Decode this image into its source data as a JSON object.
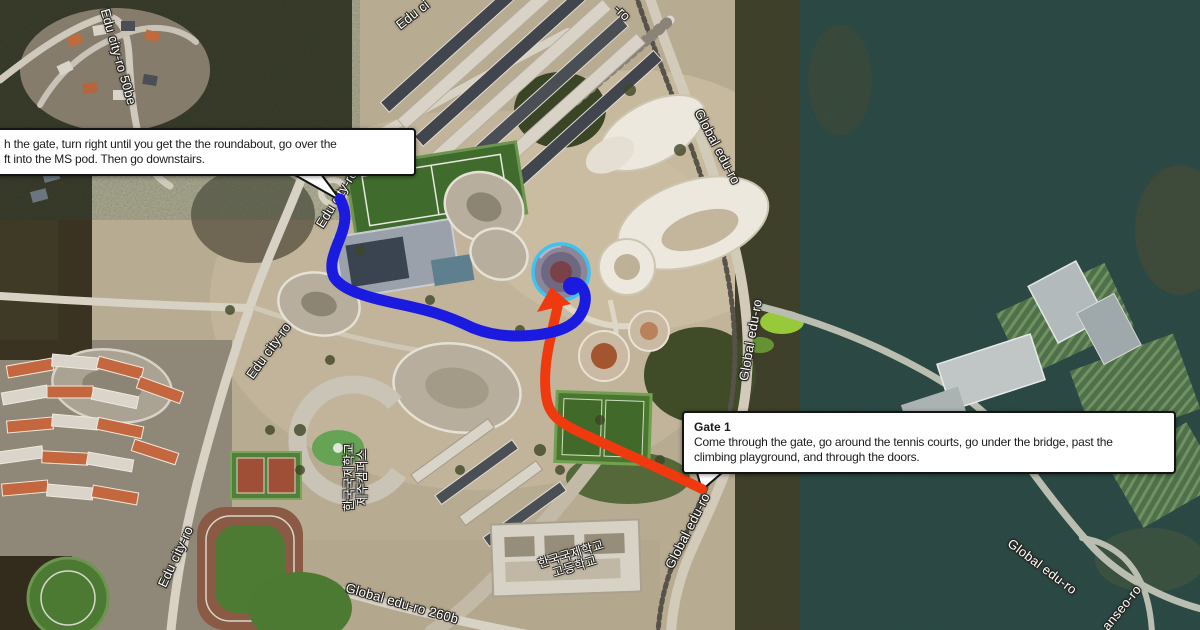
{
  "map": {
    "road_labels": [
      {
        "text": "Edu city-ro 50be",
        "x": 118,
        "y": 57,
        "rot": 74,
        "size": 13
      },
      {
        "text": "Edu ci",
        "x": 413,
        "y": 15,
        "rot": -38,
        "size": 13
      },
      {
        "text": "-ro",
        "x": 622,
        "y": 13,
        "rot": 45,
        "size": 13
      },
      {
        "text": "Global edu-ro",
        "x": 717,
        "y": 147,
        "rot": 62,
        "size": 13
      },
      {
        "text": "Global edu-ro",
        "x": 751,
        "y": 340,
        "rot": -80,
        "size": 13
      },
      {
        "text": "Global edu-ro",
        "x": 688,
        "y": 531,
        "rot": -63,
        "size": 13
      },
      {
        "text": "Edu city-ro",
        "x": 337,
        "y": 199,
        "rot": -58,
        "size": 13
      },
      {
        "text": "Edu city-ro",
        "x": 269,
        "y": 351,
        "rot": -54,
        "size": 13
      },
      {
        "text": "Edu city-ro",
        "x": 176,
        "y": 557,
        "rot": -65,
        "size": 13
      },
      {
        "text": "Global edu-ro 260b",
        "x": 402,
        "y": 604,
        "rot": 16,
        "size": 13
      },
      {
        "text": "Global edu-ro",
        "x": 1042,
        "y": 567,
        "rot": 37,
        "size": 13
      },
      {
        "text": "anseo-ro",
        "x": 1122,
        "y": 608,
        "rot": -51,
        "size": 13
      },
      {
        "text": "한국국제학교\n제주캠퍼스",
        "x": 356,
        "y": 477,
        "rot": -90,
        "size": 12
      },
      {
        "text": "한국국제학교\n고등학교",
        "x": 573,
        "y": 561,
        "rot": -17,
        "size": 12
      }
    ],
    "routes": {
      "blue": {
        "color": "#1b1be0",
        "width": 11,
        "path": "M340,199 C346,211 347,221 340,238 C333,255 329,266 334,277 C341,289 362,296 394,303 C428,310 446,315 473,328 C498,338 523,337 543,334 C561,331 572,326 579,317 C586,307 587,296 583,289 C579,282 573,281 571,285",
        "end": {
          "x": 572,
          "y": 286,
          "r": 9
        }
      },
      "red": {
        "color": "#ee3a0e",
        "width": 10,
        "path": "M702,489 C668,472 622,452 592,438 C566,426 551,419 547,401 C543,381 546,357 551,336 C554,321 557,311 558,304",
        "arrow_points": "551,287 537,312 571,304"
      }
    },
    "target_circle": {
      "color": "#3cc3f2",
      "x": 561,
      "y": 272,
      "r": 28,
      "stroke_width": 3.5
    }
  },
  "callouts": {
    "gate2": {
      "line1": "h the gate, turn right until you get the the roundabout, go over the",
      "line2": "ft into the MS pod. Then go downstairs."
    },
    "gate1": {
      "title": "Gate 1",
      "body_line1": "Come through the gate, go around the tennis courts, go under the bridge, past the",
      "body_line2": "climbing playground, and through the doors."
    }
  }
}
